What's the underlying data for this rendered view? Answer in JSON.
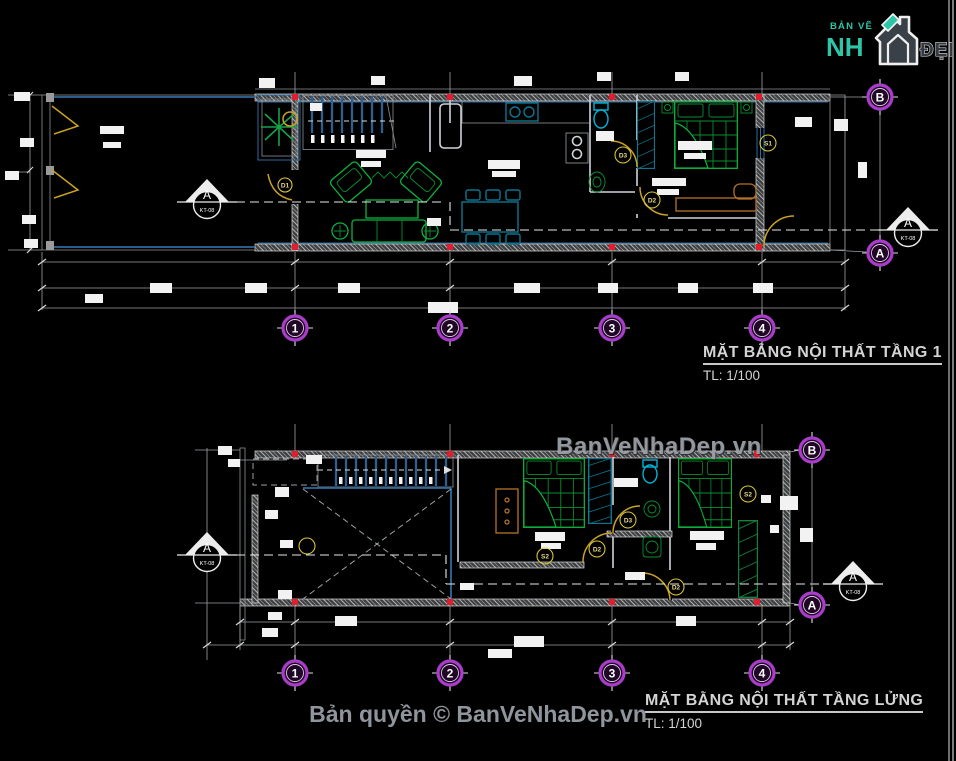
{
  "logo": {
    "tagline": "BẢN VẼ",
    "brand_left": "NH",
    "brand_right": "ĐẸP"
  },
  "watermark": "BanVeNhaDep.vn",
  "copyright": "Bản quyền © BanVeNhaDep.vn",
  "plans": {
    "plan1": {
      "title": "MẶT BẰNG NỘI THẤT TẦNG 1",
      "scale": "TL: 1/100",
      "grid_columns": [
        "1",
        "2",
        "3",
        "4"
      ],
      "grid_rows": {
        "top": "B",
        "bottom": "A"
      },
      "section_marker": {
        "letter": "A",
        "sheet": "KT-08"
      },
      "labels": {
        "door1": "D1",
        "door2": "D2",
        "door3": "D3",
        "window1": "S1"
      }
    },
    "plan2": {
      "title": "MẶT BẰNG NỘI THẤT TẦNG LỬNG",
      "scale": "TL: 1/100",
      "grid_columns": [
        "1",
        "2",
        "3",
        "4"
      ],
      "grid_rows": {
        "top": "B",
        "bottom": "A"
      },
      "section_marker": {
        "letter": "A",
        "sheet": "KT-08"
      },
      "labels": {
        "door2": "D2",
        "door3": "D3",
        "window2": "S2"
      }
    }
  },
  "colors": {
    "background": "#000000",
    "furniture_green": "#0db33c",
    "wall_blue": "#2d6a9f",
    "door_yellow": "#c9a227",
    "grid_bubble_purple": "#a93cc9",
    "marker_red": "#e11d2e",
    "logo_green": "#2ec4a8",
    "watermark_gray": "#9aa0a6"
  }
}
